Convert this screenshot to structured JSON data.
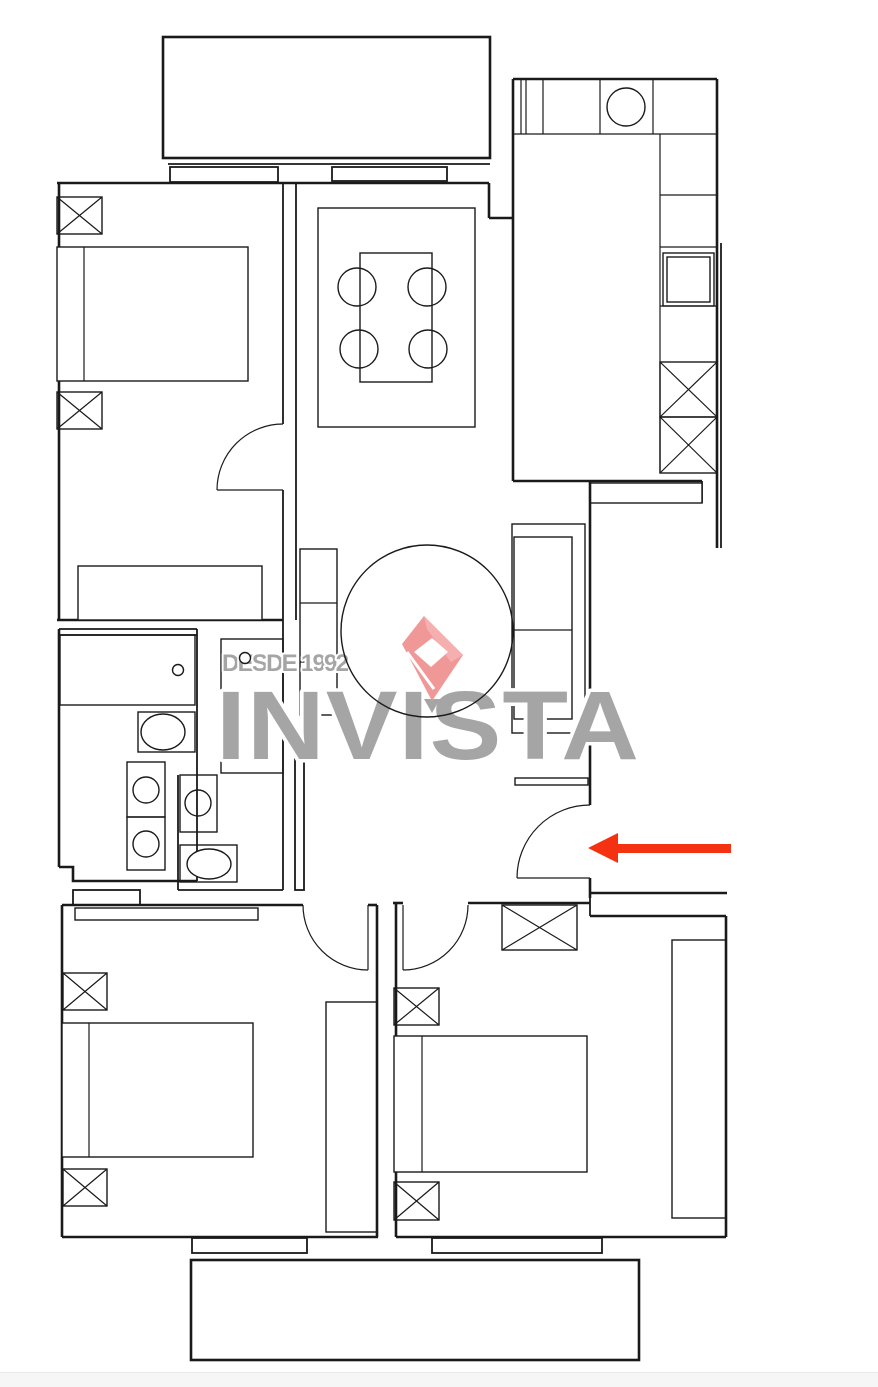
{
  "page": {
    "background": "#ffffff",
    "line_color": "#1a1a1a",
    "footer_strip_color": "#f6f6f6"
  },
  "watermark": {
    "tagline": "DESDE 1992",
    "brand": "INVISTA",
    "text_color": "#a5a5a5",
    "logo": {
      "main": "#f09898",
      "highlight": "#f6afaf",
      "hole": "#ffffff"
    }
  },
  "annotation_arrow": {
    "color": "#f43111",
    "direction": "left",
    "points_to": "entrance-door"
  },
  "plan": {
    "type": "apartment-floor-plan",
    "rooms": [
      {
        "name": "balcony-top",
        "symbols": [
          "balcony-slab",
          "window-sill",
          "window-sill"
        ]
      },
      {
        "name": "bedroom-top-left",
        "symbols": [
          "column-marker-x",
          "column-marker-x",
          "double-bed",
          "dresser",
          "door-swing"
        ]
      },
      {
        "name": "dining-room",
        "symbols": [
          "rug",
          "dining-table",
          "chair",
          "chair",
          "chair",
          "chair"
        ]
      },
      {
        "name": "kitchen",
        "symbols": [
          "counter-run",
          "sink-round",
          "fridge",
          "column-marker-x",
          "column-marker-x",
          "console-table"
        ]
      },
      {
        "name": "living-room",
        "symbols": [
          "round-rug",
          "tv-stand",
          "sofa",
          "entrance-door-swing",
          "wall-shelf"
        ]
      },
      {
        "name": "bathroom",
        "symbols": [
          "vanity-counter",
          "toilet",
          "basin",
          "basin"
        ]
      },
      {
        "name": "wc",
        "symbols": [
          "tall-cabinet",
          "basin",
          "toilet"
        ]
      },
      {
        "name": "bedroom-bottom-left",
        "symbols": [
          "door-swing",
          "radiator-shelf",
          "column-marker-x",
          "column-marker-x",
          "double-bed",
          "wardrobe"
        ]
      },
      {
        "name": "bedroom-bottom-right",
        "symbols": [
          "door-swing",
          "column-marker-x",
          "column-marker-x",
          "column-marker-x",
          "double-bed",
          "wardrobe"
        ]
      },
      {
        "name": "balcony-bottom",
        "symbols": [
          "balcony-slab",
          "window-sill",
          "window-sill"
        ]
      }
    ]
  }
}
